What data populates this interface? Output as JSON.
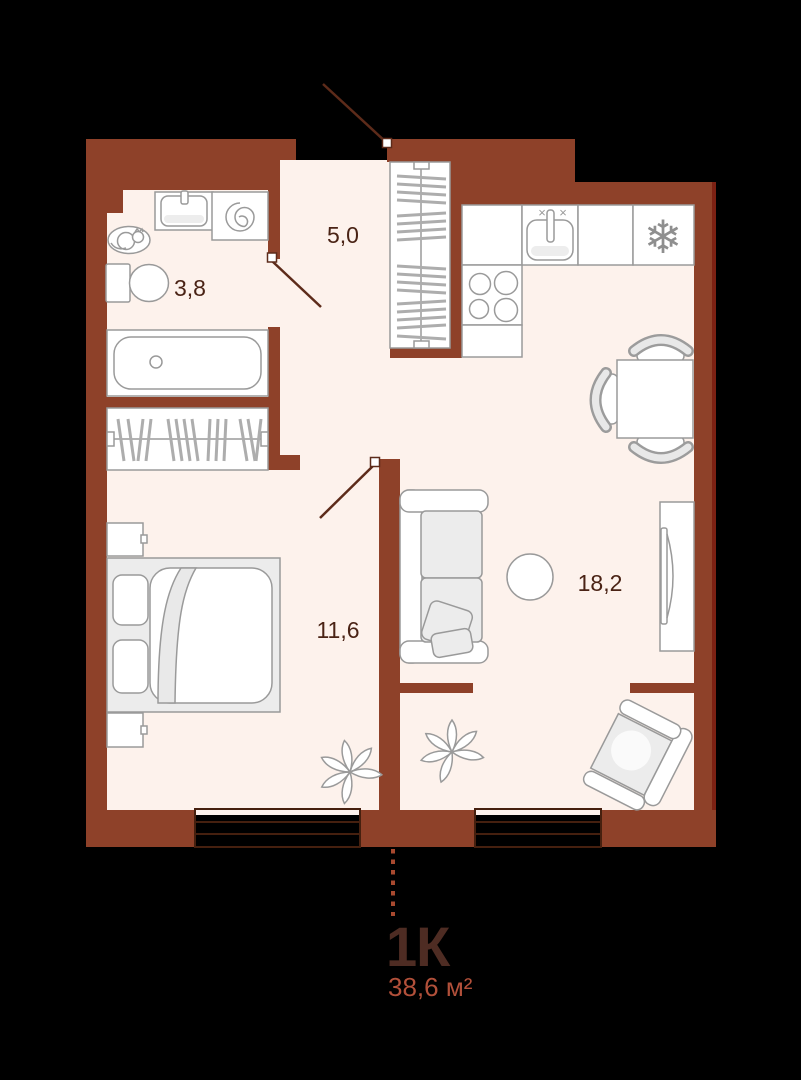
{
  "plan": {
    "type_label": "1К",
    "total_area_label": "38,6 м²",
    "rooms": [
      {
        "name": "hallway",
        "area": "5,0"
      },
      {
        "name": "bathroom",
        "area": "3,8"
      },
      {
        "name": "bedroom",
        "area": "11,6"
      },
      {
        "name": "living-kitchen",
        "area": "18,2"
      }
    ]
  },
  "icons": {
    "fridge_snowflake": "❄",
    "faucet_cross_left": "×",
    "faucet_cross_right": "×"
  },
  "colors": {
    "background": "#000000",
    "wall": "#8e4129",
    "wall_edge": "#7c2113",
    "floor": "#fdf2ec",
    "furniture_stroke": "#9a9a9a",
    "room_label": "#4a2315",
    "title": "#4e2c23",
    "area_text": "#b2503a"
  }
}
